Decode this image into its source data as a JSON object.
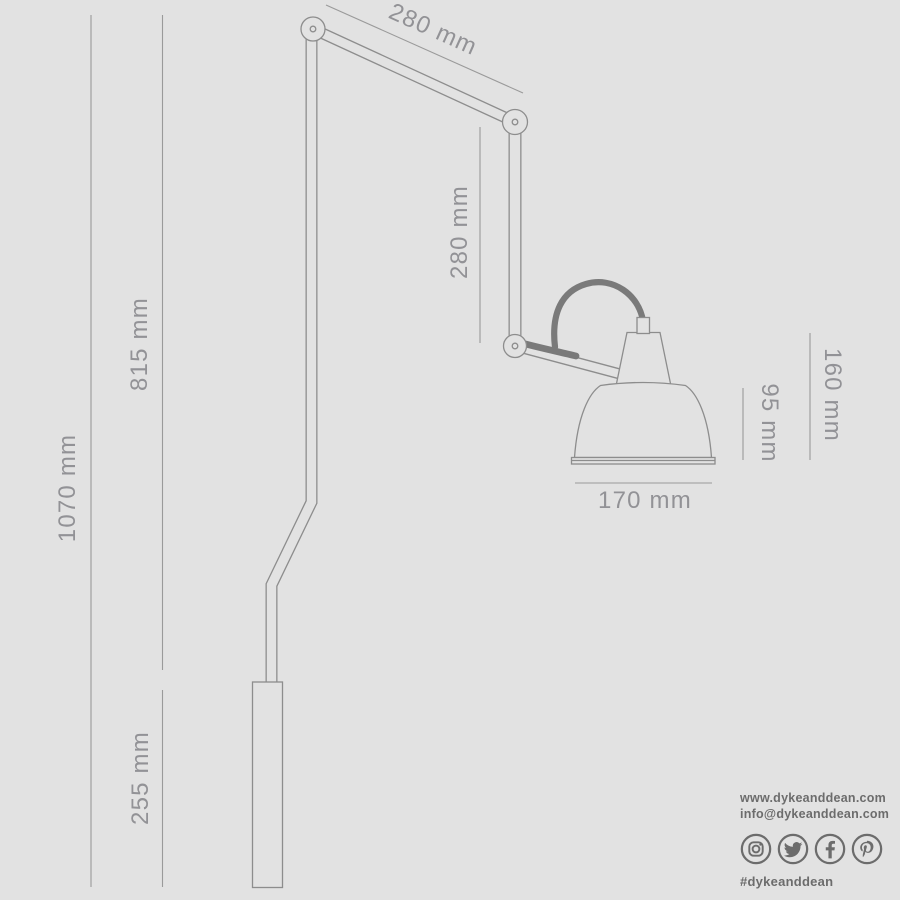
{
  "canvas": {
    "background_color": "#e2e2e2",
    "drawing_line_color": "#8d8d8d",
    "cable_color": "#7a7a7a",
    "dim_line_color": "#9a9a9a",
    "dim_label_color": "#929296"
  },
  "dimensions": {
    "upper_arm_length": "280 mm",
    "forearm_length": "280 mm",
    "overall_height": "1070 mm",
    "stem_height": "815 mm",
    "wall_bracket_height": "255 mm",
    "head_height": "160 mm",
    "shade_height": "95 mm",
    "shade_diameter": "170 mm"
  },
  "footer": {
    "website": "www.dykeanddean.com",
    "email": "info@dykeanddean.com",
    "hashtag": "#dykeanddean",
    "text_color": "#6c6c6c",
    "social": [
      {
        "name": "instagram-icon"
      },
      {
        "name": "twitter-icon"
      },
      {
        "name": "facebook-icon"
      },
      {
        "name": "pinterest-icon"
      }
    ]
  }
}
